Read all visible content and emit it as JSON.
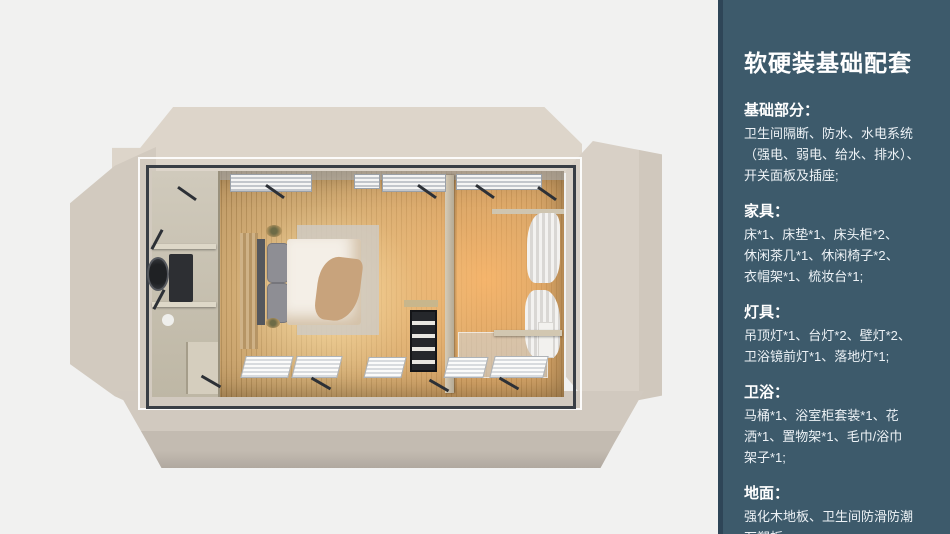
{
  "panel": {
    "title": "软硬装基础配套",
    "sections": [
      {
        "heading": "基础部分：",
        "body": "卫生间隔断、防水、水电系统\n（强电、弱电、给水、排水）、\n开关面板及插座;"
      },
      {
        "heading": "家具：",
        "body": "床*1、床垫*1、床头柜*2、\n休闲茶几*1、休闲椅子*2、\n衣帽架*1、梳妆台*1;"
      },
      {
        "heading": "灯具：",
        "body": "吊顶灯*1、台灯*2、壁灯*2、\n卫浴镜前灯*1、落地灯*1;"
      },
      {
        "heading": "卫浴：",
        "body": "马桶*1、浴室柜套装*1、花\n洒*1、置物架*1、毛巾/浴巾\n架子*1;"
      },
      {
        "heading": "地面：",
        "body": "强化木地板、卫生间防滑防潮\n石塑板;"
      }
    ]
  },
  "colors": {
    "panel_background": "#3d5a6b",
    "panel_border": "#2e4557",
    "canvas_background": "#f1f1f0",
    "shell_beige": "#d6cec4",
    "wood_floor": "#b08a55",
    "warm_glow": "#ffd9a0",
    "frame_steel": "#393e45",
    "text": "#ffffff"
  }
}
